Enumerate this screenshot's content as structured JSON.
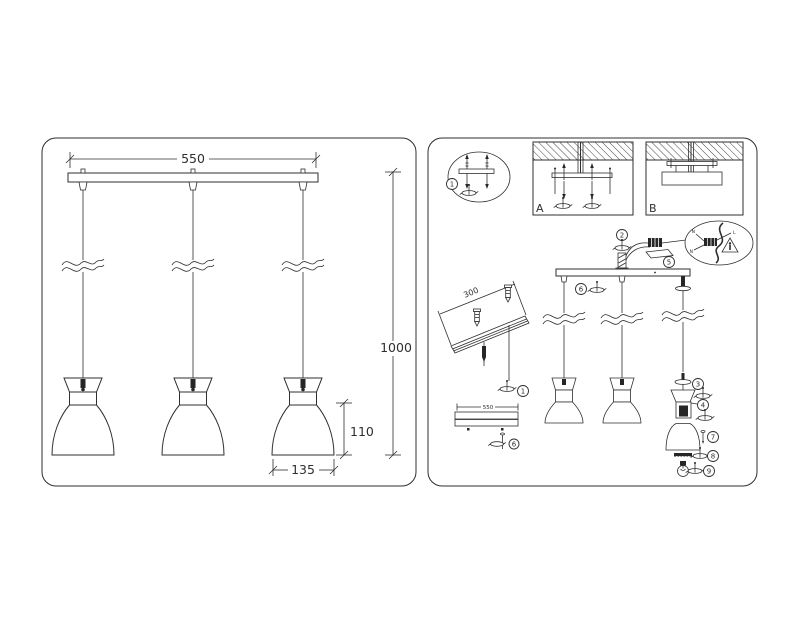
{
  "colors": {
    "ink": "#2f2f2f",
    "background": "#ffffff"
  },
  "drawing": {
    "left": {
      "dim_width": "550",
      "dim_height": "1000",
      "dim_shade_height": "110",
      "dim_shade_width": "135"
    },
    "right": {
      "mount_a": "A",
      "mount_b": "B",
      "rail_dim": "300",
      "bar_dim": "550",
      "wire_n_top": "N",
      "wire_l": "L",
      "wire_n_left": "N",
      "callout_anchor": "1",
      "callout_anchor_rail": "1",
      "callout_cord_grip": "2",
      "callout_locknut": "3",
      "callout_lampholder": "4",
      "callout_terminal": "5",
      "callout_bar_screw": "6",
      "callout_bar_screw_detail": "6",
      "callout_shade_screw": "7",
      "callout_shade_ring": "8",
      "callout_bulb": "9"
    }
  }
}
